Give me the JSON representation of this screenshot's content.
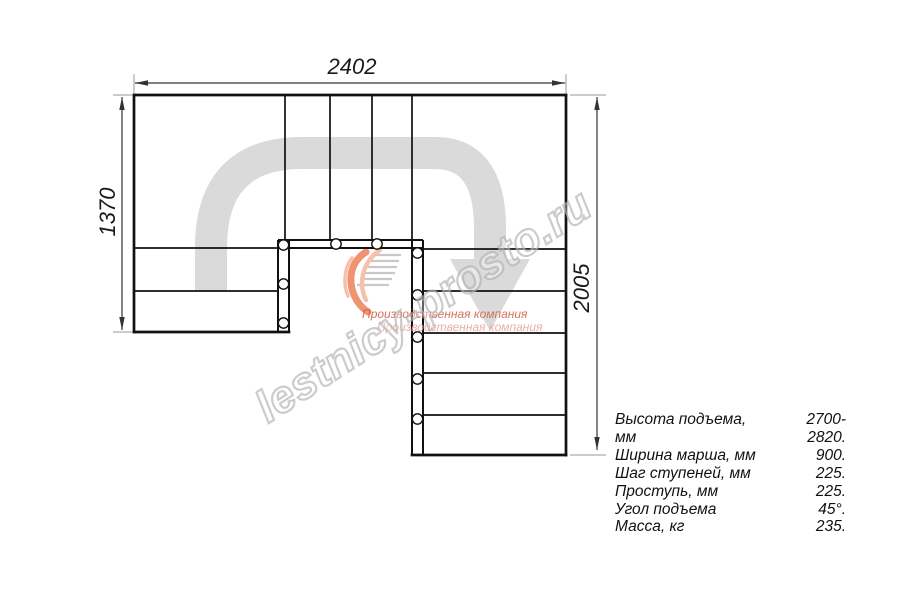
{
  "drawing": {
    "title": "staircase-floor-plan",
    "dimensions": {
      "top": "2402",
      "left": "1370",
      "right": "2005"
    }
  },
  "specs": {
    "rows": [
      {
        "label": "Высота подъема, мм",
        "value": "2700-2820."
      },
      {
        "label": "Ширина марша, мм",
        "value": "900."
      },
      {
        "label": "Шаг ступеней, мм",
        "value": "225."
      },
      {
        "label": "Проступь, мм",
        "value": "225."
      },
      {
        "label": "Угол подъема",
        "value": "45°."
      },
      {
        "label": "Масса, кг",
        "value": "235."
      }
    ]
  },
  "watermark": {
    "site": "lestnicy-prosto.ru",
    "company_line1": "Производственная компания",
    "company_line2": "Производственная компания"
  },
  "colors": {
    "line": "#111111",
    "dimension": "#333333",
    "extension": "#999999",
    "walk_line": "#dadada",
    "watermark_outline": "#adadad",
    "logo_flame": "#ef9372",
    "logo_hatch": "#c8c8c8",
    "company_text": "#cf5a42",
    "company_text_light": "#eaa79b"
  }
}
